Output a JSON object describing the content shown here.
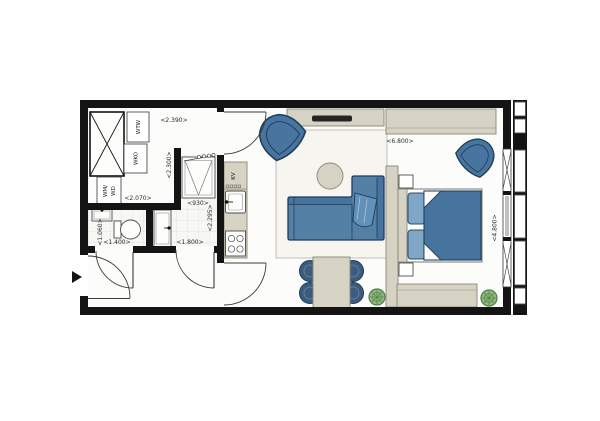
{
  "plan": {
    "type": "apartment-floor-plan",
    "colors": {
      "wall": "#141414",
      "furniture_blue": "#47759f",
      "furniture_blue_dark": "#1f3c59",
      "pillow_blue": "#7fa6c7",
      "cabinet_beige": "#d6d3c4",
      "cabinet_outline": "#8a887a",
      "plant_green": "#8fb97e",
      "floor": "#fcfcfa",
      "tile": "#f7f7f3"
    },
    "labels": {
      "wtw": "WTW",
      "wko": "WKO",
      "wm_wd_line1": "WM/",
      "wm_wd_line2": "WD",
      "kv": "KV"
    },
    "dims": {
      "storage_width": "<2.390>",
      "wm_zone_width": "<2.070>",
      "storage_depth": "<2.300>",
      "shower_width": "<930>",
      "bathroom_depth": "<2.295>",
      "toilet_width": "<1.400>",
      "toilet_depth": "<1.060>",
      "bathroom_width": "<1.800>",
      "living_width": "<6.800>",
      "bedroom_depth": "<4.800>"
    },
    "rooms": {
      "technical": [
        "shaft",
        "ventilation-unit-wtw",
        "heat-pump-wko",
        "washer-dryer"
      ],
      "toilet": [
        "hand-basin",
        "wc"
      ],
      "bathroom": [
        "shower-cabin",
        "vanity-basin"
      ],
      "hall": [
        "entrance-door"
      ],
      "kitchen": [
        "tall-cabinet-kv",
        "kitchen-sink",
        "cooktop"
      ],
      "living": [
        "tv-sideboard",
        "armchair",
        "chaise-sofa",
        "coffee-table",
        "rug",
        "dining-table",
        "dining-chairs",
        "plant"
      ],
      "bedroom": [
        "wardrobe",
        "room-divider",
        "double-bed",
        "nightstands",
        "armchair",
        "low-sideboard",
        "plant"
      ]
    }
  }
}
